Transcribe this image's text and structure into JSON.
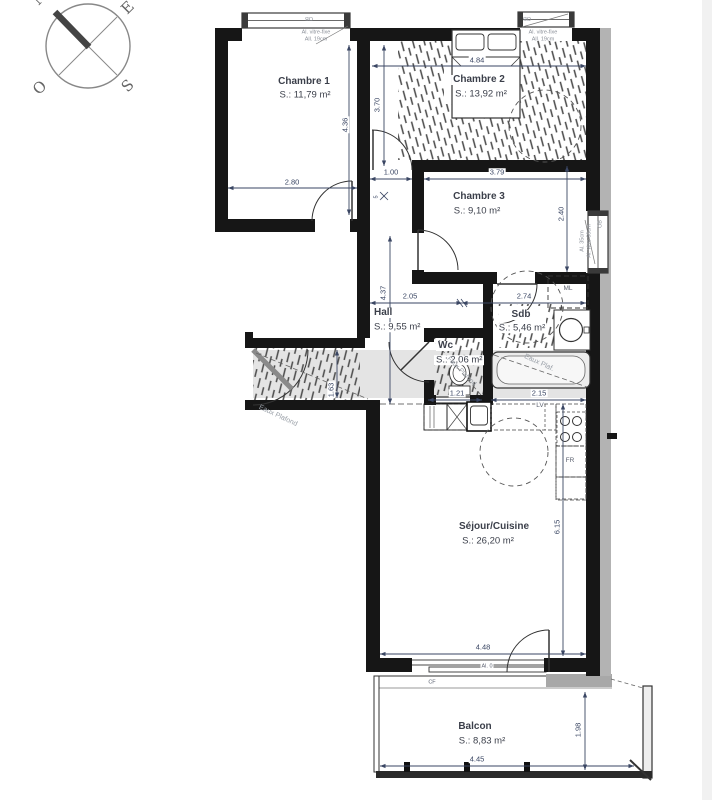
{
  "compass": {
    "n": "N",
    "e": "E",
    "s": "S",
    "o": "O"
  },
  "rooms": {
    "chambre1": {
      "name": "Chambre 1",
      "area": "S.: 11,79 m²"
    },
    "chambre2": {
      "name": "Chambre 2",
      "area": "S.: 13,92 m²"
    },
    "chambre3": {
      "name": "Chambre 3",
      "area": "S.: 9,10 m²"
    },
    "hall": {
      "name": "Hall",
      "area": "S.: 9,55 m²"
    },
    "wc": {
      "name": "Wc",
      "area": "S.: 2,06 m²"
    },
    "sdb": {
      "name": "Sdb",
      "area": "S.: 5,46 m²"
    },
    "sejour": {
      "name": "Séjour/Cuisine",
      "area": "S.: 26,20 m²"
    },
    "balcon": {
      "name": "Balcon",
      "area": "S.: 8,83 m²"
    }
  },
  "dims": {
    "ch1_width": "2.80",
    "ch1_height": "4.36",
    "ch2_width": "4.84",
    "ch2_left_height": "3.70",
    "passage_width": "1.00",
    "wall_offset": "5",
    "ch3_width": "3.79",
    "ch3_height": "2.40",
    "hall_width": "2.05",
    "sdb_width": "2.74",
    "hall_height": "4.37",
    "entry_width": "1.63",
    "wc_width": "1.21",
    "kitchen_width": "2.15",
    "sejour_height": "6.15",
    "sejour_width": "4.48",
    "balcon_width": "4.45",
    "balcon_depth": "1.98"
  },
  "annotations": {
    "window_label_1": "OB",
    "window_label_2": "OB",
    "window_label_3": "OB",
    "win1_note_l1": "Al. vitre-fixe",
    "win1_note_l2": "All. 19cm",
    "win2_note_l1": "Al. vitre-fixe",
    "win2_note_l2": "All. 19cm",
    "win3_note_l1": "Al. 35cm",
    "win3_note_l2": "Al. vitre 60cm",
    "washing_machine": "ML",
    "dishwasher": "LV",
    "fridge": "FR",
    "shutter_box": "CF",
    "threshold": "Al. 0",
    "ceiling_entry": "Eaux Plafond",
    "ceiling_wc": "Faux Plafond",
    "ceiling_bath": "Eaux Plaf."
  }
}
